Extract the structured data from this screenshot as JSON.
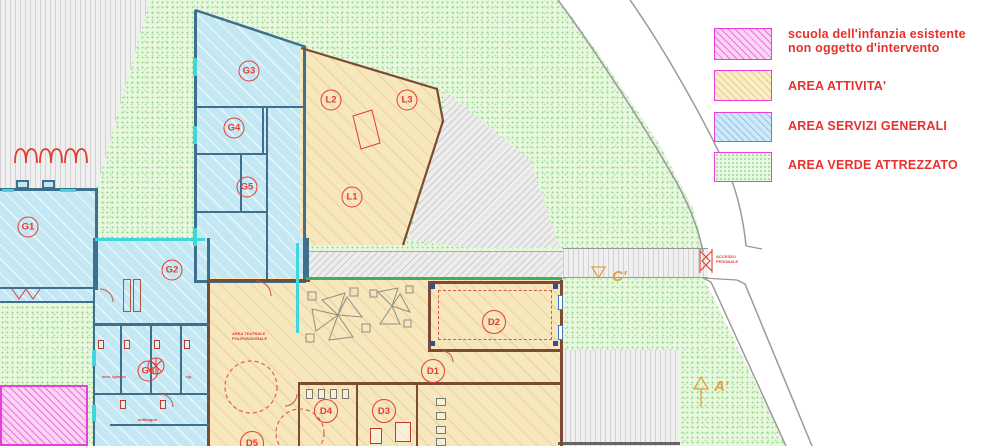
{
  "legend": {
    "items": [
      {
        "line1": "scuola dell'infanzia esistente",
        "line2": "non oggetto d'intervento"
      },
      {
        "line1": "AREA ATTIVITA'",
        "line2": ""
      },
      {
        "line1": "AREA SERVIZI GENERALI",
        "line2": ""
      },
      {
        "line1": "AREA VERDE ATTREZZATO",
        "line2": ""
      }
    ]
  },
  "rooms": {
    "G1": "G1",
    "G2": "G2",
    "G3": "G3",
    "G4": "G4",
    "G5": "G5",
    "G6": "G6",
    "L1": "L1",
    "L2": "L2",
    "L3": "L3",
    "D1": "D1",
    "D2": "D2",
    "D3": "D3",
    "D4": "D4",
    "D5": "D5"
  },
  "markers": {
    "section_c": "C'",
    "section_a": "A'"
  },
  "notes": {
    "area_note_line1": "AREA TEATRALE",
    "area_note_line2": "POLIFUNZIONALE",
    "gate_note_line1": "ACCESSO",
    "gate_note_line2": "PEDONALE",
    "g6_note_left": "serv. igienici",
    "g6_note_right": "rip.",
    "g6_note_bottom": "antibagno"
  },
  "colors": {
    "legend_text": "#e8312e",
    "label_red": "#e23c30",
    "marker_orange": "#dfa13f",
    "area_attivita": "#f7e7bc",
    "area_servizi_generali": "#c3e8f4",
    "area_verde_attrezzato": "#e7f8df",
    "scuola_esistente": "#fbd3f4",
    "swatch_border": "#e83fd8"
  }
}
